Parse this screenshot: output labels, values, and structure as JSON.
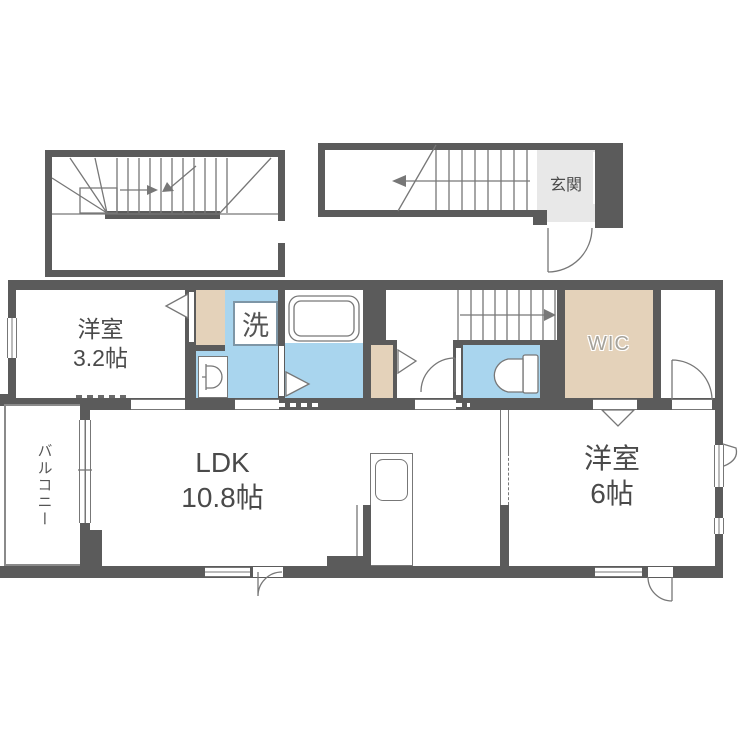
{
  "floorplan": {
    "labels": {
      "bedroom_small_name": "洋室",
      "bedroom_small_size": "3.2帖",
      "ldk_name": "LDK",
      "ldk_size": "10.8帖",
      "bedroom_main_name": "洋室",
      "bedroom_main_size": "6帖",
      "wic": "WIC",
      "entrance": "玄関",
      "laundry": "洗",
      "balcony": "バルコニー"
    },
    "colors": {
      "wall": "#5b5b5b",
      "line": "#777777",
      "water": "#a9d5ee",
      "closet": "#e4d2ba",
      "entry": "#e8e8e8",
      "text": "#4a4a4a",
      "wictext": "#a5a29a",
      "laundry": "#7e96a6"
    }
  }
}
